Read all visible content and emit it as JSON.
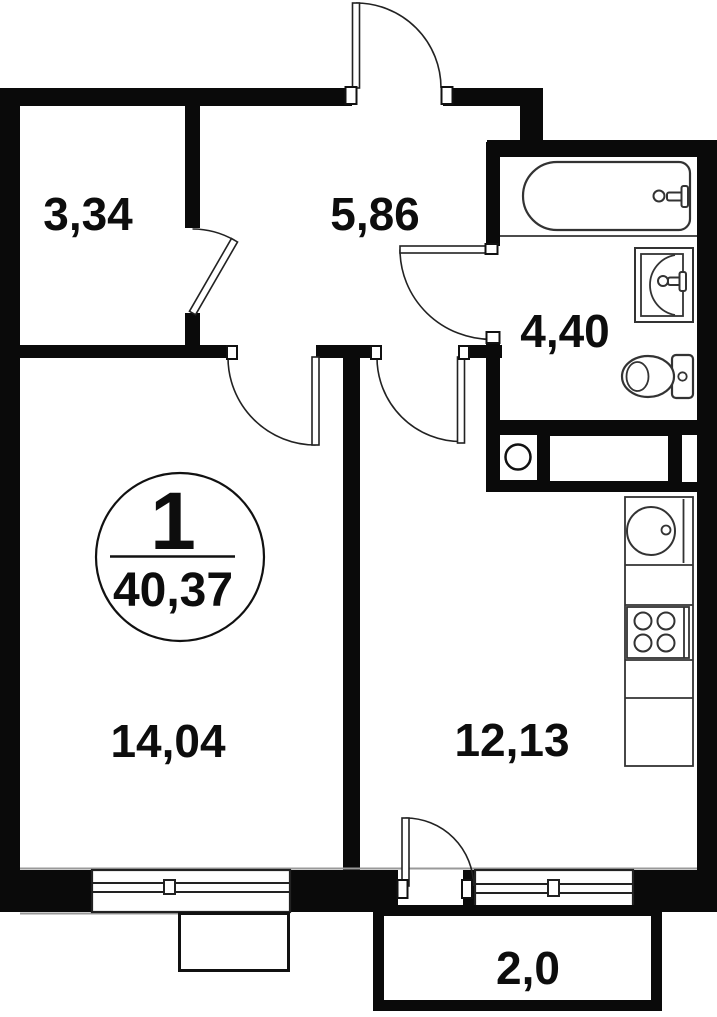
{
  "plan": {
    "title": "apartment-floor-plan",
    "badge": {
      "flat_number": "1",
      "total_area": "40,37"
    },
    "rooms": [
      {
        "name": "storage",
        "label": "3,34"
      },
      {
        "name": "hallway",
        "label": "5,86"
      },
      {
        "name": "bathroom",
        "label": "4,40"
      },
      {
        "name": "living-room",
        "label": "14,04"
      },
      {
        "name": "kitchen",
        "label": "12,13"
      },
      {
        "name": "balcony",
        "label": "2,0"
      }
    ],
    "fixtures": [
      "bathtub",
      "wash-basin",
      "toilet",
      "washing-machine",
      "kitchen-sink",
      "stove",
      "entrance-door",
      "balcony-door",
      "window"
    ],
    "colors": {
      "wall": "#0a0a0a",
      "line": "#222222",
      "thin_line": "#333333",
      "face_line": "#999999",
      "background": "#ffffff",
      "text": "#0d0d0d"
    }
  }
}
